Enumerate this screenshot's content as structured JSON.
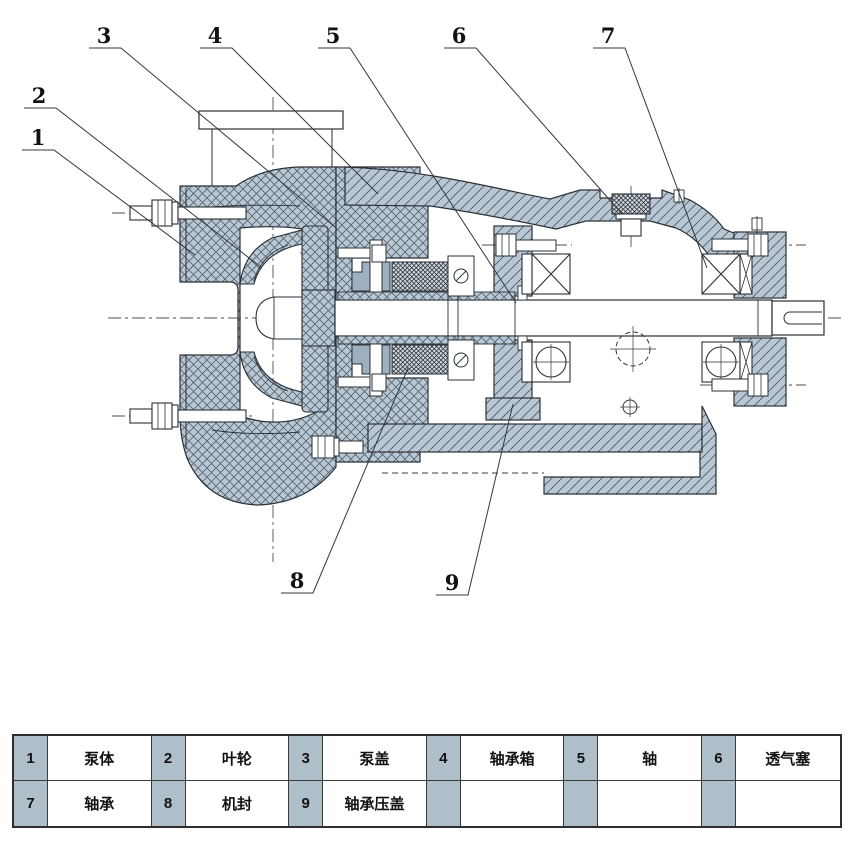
{
  "diagram": {
    "description": "Centrifugal pump cross-section drawing",
    "callouts": [
      {
        "n": "1"
      },
      {
        "n": "2"
      },
      {
        "n": "3"
      },
      {
        "n": "4"
      },
      {
        "n": "5"
      },
      {
        "n": "6"
      },
      {
        "n": "7"
      },
      {
        "n": "8"
      },
      {
        "n": "9"
      }
    ]
  },
  "table": {
    "rows": [
      [
        {
          "num": "1",
          "name": "泵体"
        },
        {
          "num": "2",
          "name": "叶轮"
        },
        {
          "num": "3",
          "name": "泵盖"
        },
        {
          "num": "4",
          "name": "轴承箱"
        },
        {
          "num": "5",
          "name": "轴"
        },
        {
          "num": "6",
          "name": "透气塞"
        }
      ],
      [
        {
          "num": "7",
          "name": "轴承"
        },
        {
          "num": "8",
          "name": "机封"
        },
        {
          "num": "9",
          "name": "轴承压盖"
        },
        {
          "num": "",
          "name": ""
        },
        {
          "num": "",
          "name": ""
        },
        {
          "num": "",
          "name": ""
        }
      ]
    ]
  },
  "colors": {
    "metal_fill": "#b9c7d4",
    "hatch_line": "#54646f",
    "outline": "#2b3036",
    "table_number_bg": "#aebfca"
  }
}
